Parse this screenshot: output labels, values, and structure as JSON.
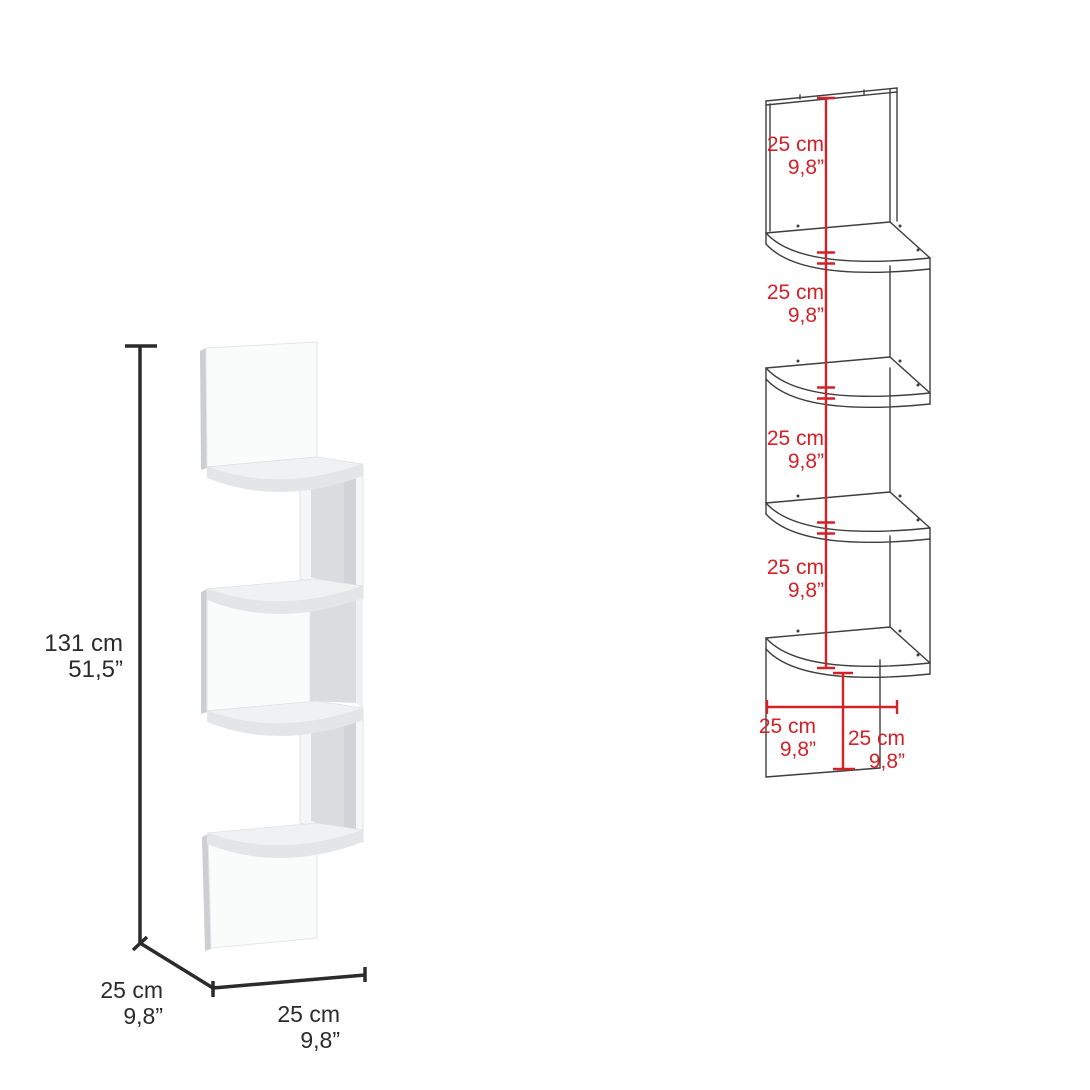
{
  "colors": {
    "dimension_black": "#2b2b2b",
    "dimension_red": "#d42127",
    "render_face": "#fafbfb",
    "render_interior": "#dadcde"
  },
  "left_figure": {
    "height_cm": "131 cm",
    "height_in": "51,5”",
    "depth_cm": "25 cm",
    "depth_in": "9,8”",
    "width_cm": "25 cm",
    "width_in": "9,8”"
  },
  "right_figure": {
    "sections": [
      {
        "cm": "25 cm",
        "in": "9,8”"
      },
      {
        "cm": "25 cm",
        "in": "9,8”"
      },
      {
        "cm": "25 cm",
        "in": "9,8”"
      },
      {
        "cm": "25 cm",
        "in": "9,8”"
      }
    ],
    "bottom_width_cm": "25 cm",
    "bottom_width_in": "9,8”",
    "bottom_depth_cm": "25 cm",
    "bottom_depth_in": "9,8”"
  }
}
